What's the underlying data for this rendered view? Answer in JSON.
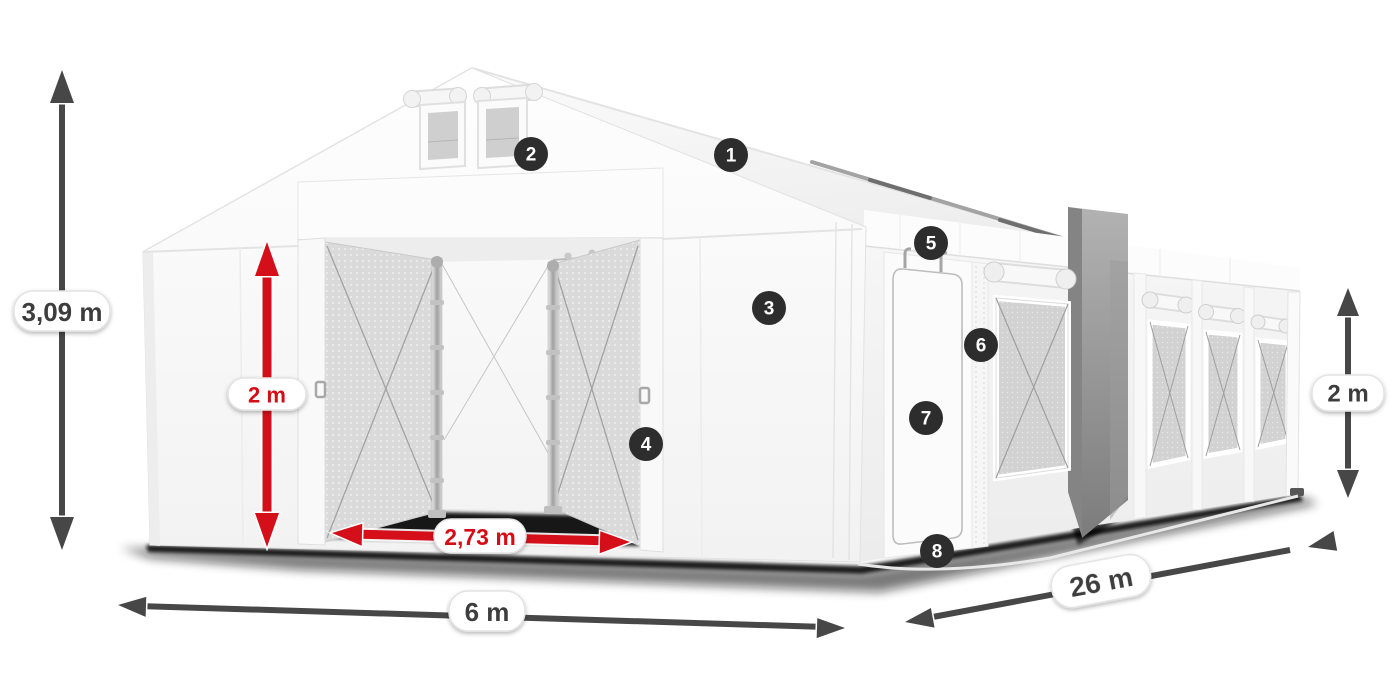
{
  "scene": {
    "description": "White marquee party tent 6x26 m, 3D product dimension diagram with numbered feature hotspots",
    "background": "#ffffff"
  },
  "colors": {
    "accent_red": "#d40f19",
    "arrow_dark": "#474747",
    "badge_background": "#2d2d2d",
    "label_text": "#3c3c3c"
  },
  "measurements": {
    "total_height": {
      "label": "3,09 m"
    },
    "door_height": {
      "label": "2 m"
    },
    "door_width": {
      "label": "2,73 m"
    },
    "front_width": {
      "label": "6 m"
    },
    "length": {
      "label": "26 m"
    },
    "side_height": {
      "label": "2 m"
    }
  },
  "markers": [
    {
      "number": "1"
    },
    {
      "number": "2"
    },
    {
      "number": "3"
    },
    {
      "number": "4"
    },
    {
      "number": "5"
    },
    {
      "number": "6"
    },
    {
      "number": "7"
    },
    {
      "number": "8"
    }
  ]
}
